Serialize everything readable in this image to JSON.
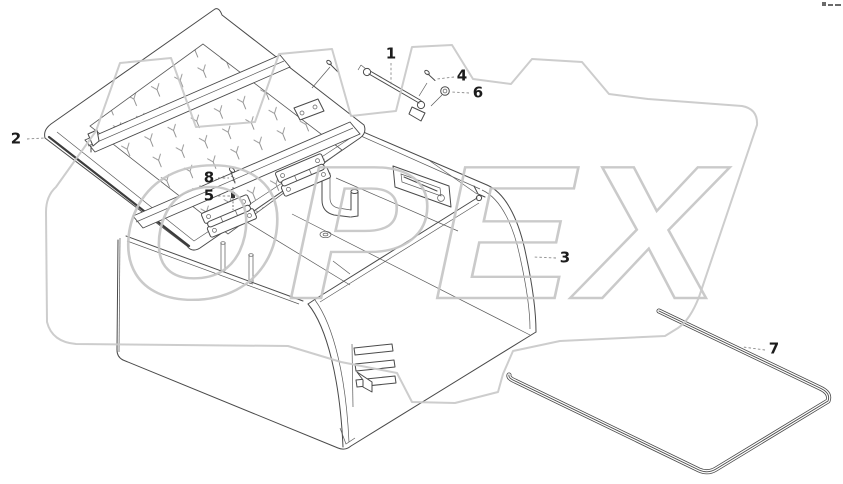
{
  "watermark": {
    "text": "OPEX",
    "color": "#c9c9c9"
  },
  "callouts": [
    {
      "label": "1"
    },
    {
      "label": "2"
    },
    {
      "label": "3"
    },
    {
      "label": "4"
    },
    {
      "label": "5"
    },
    {
      "label": "6"
    },
    {
      "label": "7"
    },
    {
      "label": "8"
    }
  ],
  "colors": {
    "background": "#ffffff",
    "line_art": "#4a4a4a",
    "label_text": "#1c1c1c",
    "leader_line": "#8a8a8a",
    "watermark_gray": "#c9c9c9"
  }
}
